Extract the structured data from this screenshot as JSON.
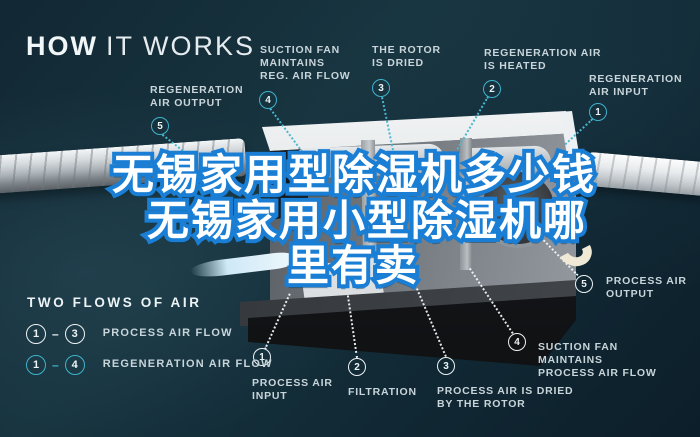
{
  "title": {
    "bold": "HOW",
    "light": "IT WORKS"
  },
  "colors": {
    "background": "#122b37",
    "teal_accent": "#3db3cc",
    "white_circle": "#eef3f5",
    "label_text": "#c8d5da",
    "overlay_blue": "#1a7fd4",
    "overlay_fill": "#ffffff"
  },
  "top_callouts": [
    {
      "num": "5",
      "label": "REGENERATION AIR OUTPUT"
    },
    {
      "num": "4",
      "label": "SUCTION FAN MAINTAINS REG. AIR FLOW"
    },
    {
      "num": "3",
      "label": "THE ROTOR IS DRIED"
    },
    {
      "num": "2",
      "label": "REGENERATION AIR IS HEATED"
    },
    {
      "num": "1",
      "label": "REGENERATION AIR INPUT"
    }
  ],
  "bottom_callouts": [
    {
      "num": "1",
      "label": "PROCESS AIR INPUT"
    },
    {
      "num": "2",
      "label": "FILTRATION"
    },
    {
      "num": "3",
      "label": "PROCESS AIR IS DRIED BY THE ROTOR"
    },
    {
      "num": "4",
      "label": "SUCTION FAN MAINTAINS PROCESS AIR FLOW"
    },
    {
      "num": "5",
      "label": "PROCESS AIR OUTPUT"
    }
  ],
  "legend": {
    "title": "TWO FLOWS OF AIR",
    "dash": "–",
    "rows": [
      {
        "from": "1",
        "to": "3",
        "label": "PROCESS AIR FLOW",
        "style": "white"
      },
      {
        "from": "1",
        "to": "4",
        "label": "REGENERATION AIR FLOW",
        "style": "teal"
      }
    ]
  },
  "overlay_text": {
    "line1": "无锡家用型除湿机多少钱",
    "line2": "无锡家用小型除湿机哪",
    "line3": "里有卖"
  }
}
